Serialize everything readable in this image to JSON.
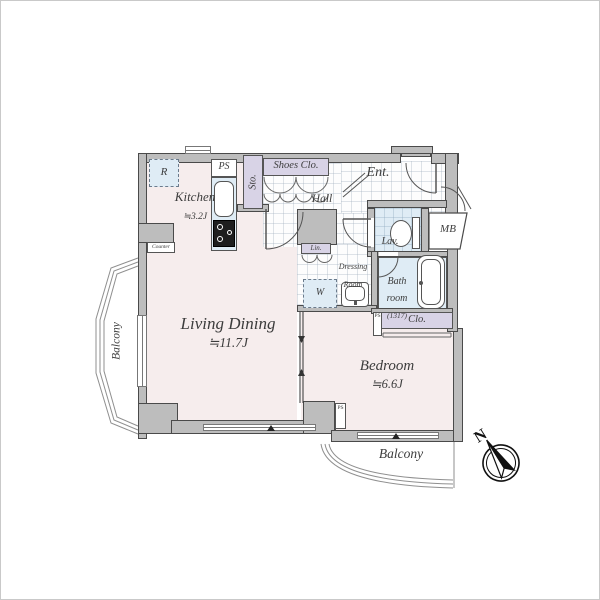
{
  "rooms": {
    "living_dining": {
      "name": "Living Dining",
      "size": "≒11.7J"
    },
    "bedroom": {
      "name": "Bedroom",
      "size": "≒6.6J"
    },
    "kitchen": {
      "name": "Kitchen",
      "size": "≒3.2J"
    },
    "bath": {
      "line1": "Bath",
      "line2": "room",
      "size": "(1317)"
    },
    "lavatory": {
      "name": "Lav."
    },
    "entrance": {
      "name": "Ent."
    },
    "hall": {
      "name": "Hall"
    },
    "dressing": {
      "line1": "Dressing",
      "line2": "Room"
    },
    "storage": {
      "name": "Sto."
    },
    "shoes_closet": {
      "name": "Shoes Clo."
    },
    "closet": {
      "name": "Clo."
    },
    "linen": {
      "name": "Lin."
    },
    "meter_box": {
      "name": "MB"
    },
    "balcony_left": {
      "name": "Balcony"
    },
    "balcony_bottom": {
      "name": "Balcony"
    }
  },
  "fixtures": {
    "refrigerator": "R",
    "washer": "W",
    "pipe_space": "PS",
    "pipe_space_clo": "PS",
    "pipe_space_bed": "PS",
    "counter": "Counter"
  },
  "compass": {
    "north": "N"
  },
  "colors": {
    "wall": "#bdbdbd",
    "outline": "#4a4a4a",
    "floor": "#f6eded",
    "closet": "#d8d3e6",
    "wet_area": "#dfecf5"
  }
}
